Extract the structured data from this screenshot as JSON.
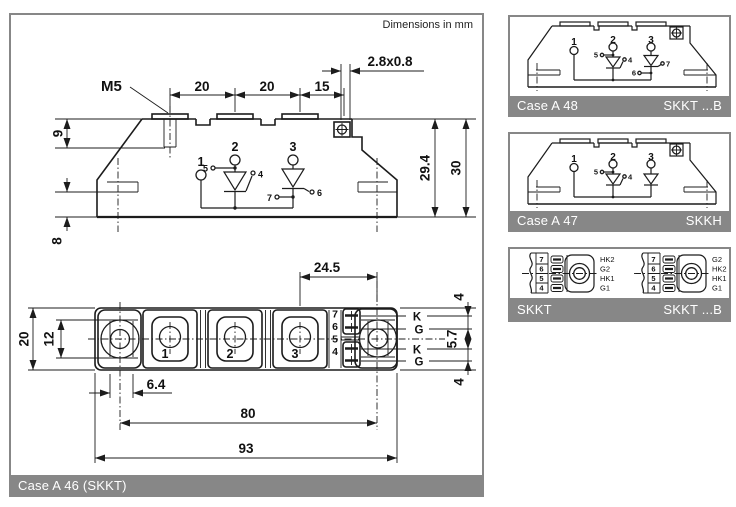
{
  "header": {
    "note": "Dimensions in mm"
  },
  "colors": {
    "gray": "#878787",
    "line": "#1c1c1c",
    "white": "#ffffff"
  },
  "main": {
    "caption": "Case A 46 (SKKT)",
    "side": {
      "m5": "M5",
      "w1": "20",
      "w2": "20",
      "w3": "15",
      "tab": "2.8x0.8",
      "h9": "9",
      "h8": "8",
      "h294": "29.4",
      "h30": "30",
      "t1": "1",
      "t2": "2",
      "t3": "3",
      "p4": "4",
      "p5": "5",
      "p6": "6",
      "p7": "7"
    },
    "top": {
      "d245": "24.5",
      "d20": "20",
      "d12": "12",
      "d64": "6.4",
      "d80": "80",
      "d93": "93",
      "d4a": "4",
      "d57": "5.7",
      "d4b": "4",
      "t1": "1",
      "t2": "2",
      "t3": "3",
      "pins": [
        "7",
        "6",
        "5",
        "4"
      ],
      "gates": [
        "K",
        "G",
        "K",
        "G"
      ]
    }
  },
  "panel_a48": {
    "caption_left": "Case A 48",
    "caption_right": "SKKT ...B",
    "t1": "1",
    "t2": "2",
    "t3": "3",
    "p4": "4",
    "p5": "5",
    "p6": "6",
    "p7": "7"
  },
  "panel_a47": {
    "caption_left": "Case A 47",
    "caption_right": "SKKH",
    "t1": "1",
    "t2": "2",
    "t3": "3",
    "p4": "4",
    "p5": "5"
  },
  "panel_pinout": {
    "caption_left": "SKKT",
    "caption_right": "SKKT ...B",
    "left": {
      "pins": [
        "7",
        "6",
        "5",
        "4"
      ],
      "labels": [
        "HK2",
        "G2",
        "HK1",
        "G1"
      ]
    },
    "right": {
      "pins": [
        "7",
        "6",
        "5",
        "4"
      ],
      "labels": [
        "G2",
        "HK2",
        "HK1",
        "G1"
      ]
    }
  }
}
